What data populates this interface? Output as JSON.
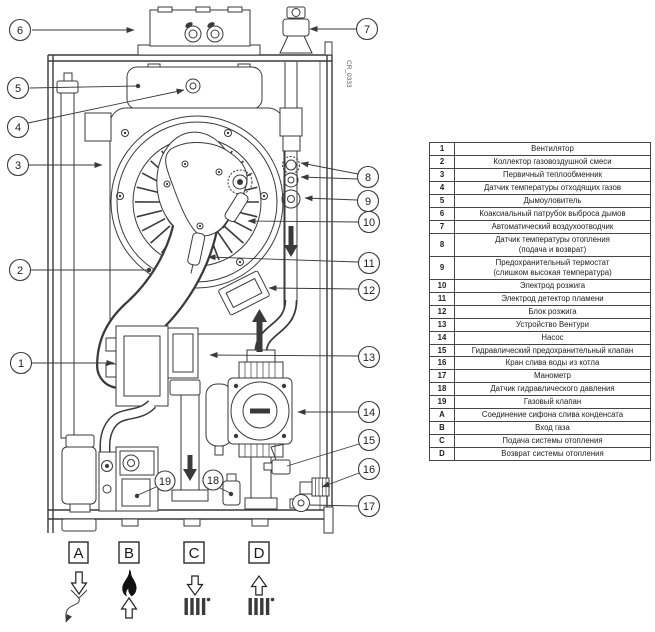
{
  "drawing_label": "CR_0333",
  "colors": {
    "line": "#3a3a3a",
    "background": "#ffffff"
  },
  "callouts": {
    "c1": "1",
    "c2": "2",
    "c3": "3",
    "c4": "4",
    "c5": "5",
    "c6": "6",
    "c7": "7",
    "c8": "8",
    "c9": "9",
    "c10": "10",
    "c11": "11",
    "c12": "12",
    "c13": "13",
    "c14": "14",
    "c15": "15",
    "c16": "16",
    "c17": "17",
    "c18": "18",
    "c19": "19"
  },
  "connections": {
    "a": "A",
    "b": "B",
    "c": "C",
    "d": "D"
  },
  "legend": {
    "rows": [
      {
        "num": "1",
        "desc": "Вентилятор"
      },
      {
        "num": "2",
        "desc": "Коллектор газовоздушной смеси"
      },
      {
        "num": "3",
        "desc": "Первичный теплообменник"
      },
      {
        "num": "4",
        "desc": "Датчик температуры отходящих газов"
      },
      {
        "num": "5",
        "desc": "Дымоуловитель"
      },
      {
        "num": "6",
        "desc": "Коаксиальный патрубок выброса дымов"
      },
      {
        "num": "7",
        "desc": "Автоматический воздухоотводчик"
      },
      {
        "num": "8",
        "desc": "Датчик температуры отопления\n(подача и возврат)"
      },
      {
        "num": "9",
        "desc": "Предохранительный термостат\n(слишком высокая температура)"
      },
      {
        "num": "10",
        "desc": "Электрод розжига"
      },
      {
        "num": "11",
        "desc": "Электрод детектор пламени"
      },
      {
        "num": "12",
        "desc": "Блок розжига"
      },
      {
        "num": "13",
        "desc": "Устройство Вентури"
      },
      {
        "num": "14",
        "desc": "Насос"
      },
      {
        "num": "15",
        "desc": "Гидравлический предохранительный клапан"
      },
      {
        "num": "16",
        "desc": "Кран слива воды из котла"
      },
      {
        "num": "17",
        "desc": "Манометр"
      },
      {
        "num": "18",
        "desc": "Датчик гидравлического давления"
      },
      {
        "num": "19",
        "desc": "Газовый клапан"
      },
      {
        "num": "A",
        "desc": "Соединение сифона слива конденсата"
      },
      {
        "num": "B",
        "desc": "Вход газа"
      },
      {
        "num": "C",
        "desc": "Подача системы отопления"
      },
      {
        "num": "D",
        "desc": "Возврат системы отопления"
      }
    ]
  }
}
